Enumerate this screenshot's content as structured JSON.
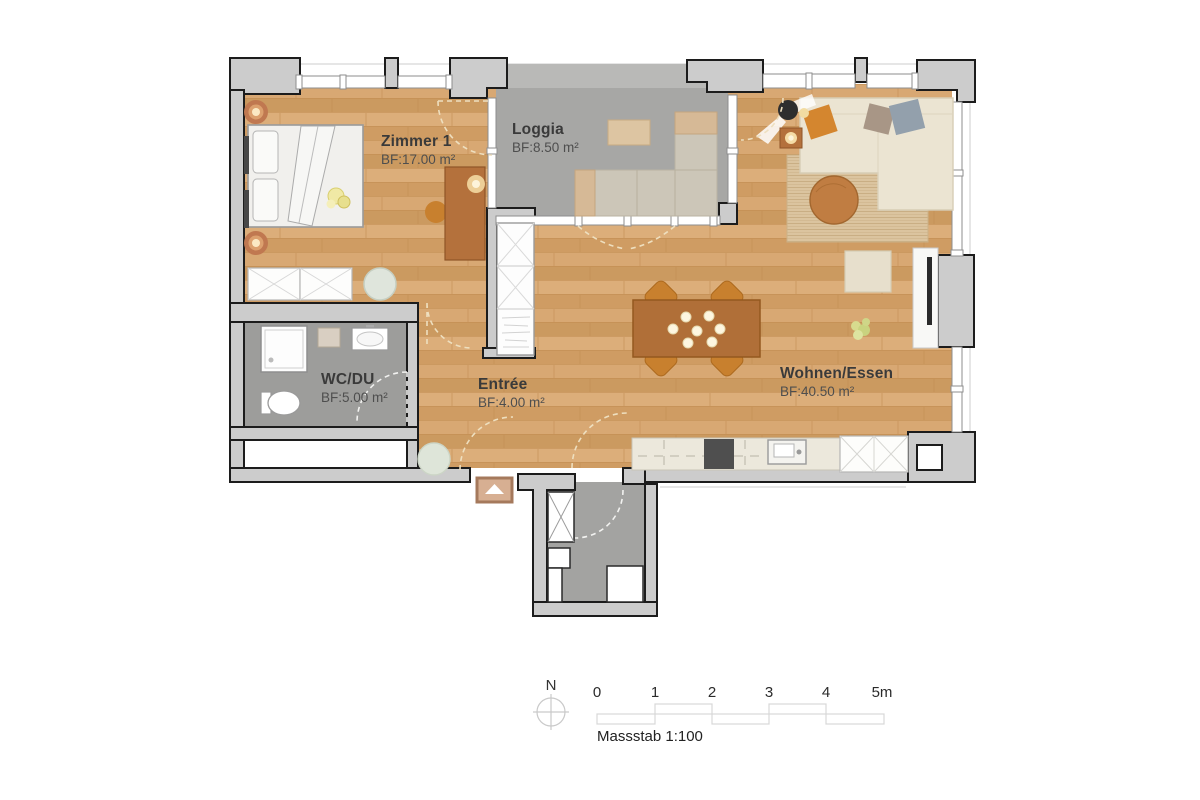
{
  "plan": {
    "rooms": [
      {
        "id": "zimmer1",
        "name": "Zimmer 1",
        "area_label": "BF:17.00 m²"
      },
      {
        "id": "loggia",
        "name": "Loggia",
        "area_label": "BF:8.50 m²"
      },
      {
        "id": "wohnen-essen",
        "name": "Wohnen/Essen",
        "area_label": "BF:40.50 m²"
      },
      {
        "id": "wc-du",
        "name": "WC/DU",
        "area_label": "BF:5.00 m²"
      },
      {
        "id": "entree",
        "name": "Entrée",
        "area_label": "BF:4.00 m²"
      }
    ],
    "compass": {
      "label": "N"
    },
    "scale_bar": {
      "tick_labels": [
        "0",
        "1",
        "2",
        "3",
        "4",
        "5m"
      ],
      "caption": "Massstab 1:100"
    },
    "colors": {
      "wall": "#cccccc",
      "wall_outline": "#1c1c1c",
      "wood_floor": "#d4a36c",
      "loggia_floor": "#a7a7a5",
      "loggia_canopy": "#b9b9b7",
      "wc_floor": "#9d9d9b",
      "stair_floor": "#a3a3a1",
      "door_arc": "#eedfbf",
      "kitchen_counter": "#ece8dc",
      "stove": "#4f4f4f",
      "sofa": "#ebe4d2",
      "rug": "#dbc49f",
      "table_wood": "#b06f38",
      "chair_orange": "#c8802e",
      "entrance_marker_fill": "#d7af92",
      "entrance_marker_border": "#a5795c",
      "label_text": "#3a3a3a"
    }
  }
}
